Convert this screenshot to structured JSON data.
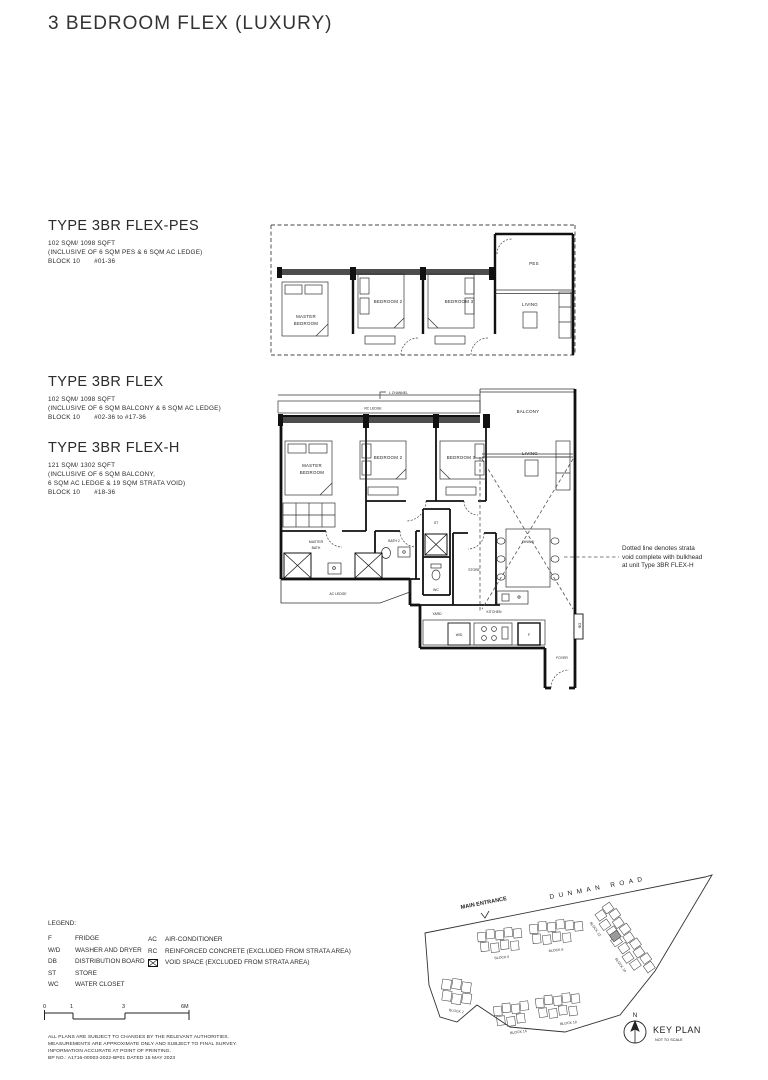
{
  "title": "3 BEDROOM FLEX (LUXURY)",
  "types": {
    "pes": {
      "name": "TYPE 3BR FLEX-PES",
      "area": "102 SQM/ 1098 SQFT",
      "line1": "(INCLUSIVE OF 6 SQM PES & 6 SQM AC LEDGE)",
      "block": "BLOCK 10",
      "stack": "#01-36"
    },
    "flex": {
      "name": "TYPE 3BR FLEX",
      "area": "102 SQM/ 1098 SQFT",
      "line1": "(INCLUSIVE OF 6 SQM BALCONY & 6 SQM AC LEDGE)",
      "block": "BLOCK 10",
      "stack": "#02-36 to #17-36"
    },
    "flexh": {
      "name": "TYPE 3BR FLEX-H",
      "area": "121 SQM/ 1302 SQFT",
      "line1": "(INCLUSIVE OF 6 SQM BALCONY,",
      "line2": "6 SQM AC LEDGE & 19 SQM STRATA VOID)",
      "block": "BLOCK 10",
      "stack": "#18-36"
    }
  },
  "plan_pes": {
    "master1": "MASTER",
    "master2": "BEDROOM",
    "bedroom2": "BEDROOM 2",
    "bedroom3": "BEDROOM 3",
    "living": "LIVING",
    "pes": "PES"
  },
  "plan_main": {
    "l_channel": "L CHANNEL",
    "rc_ledge": "RC LEDGE",
    "balcony": "BALCONY",
    "master1": "MASTER",
    "master2": "BEDROOM",
    "bedroom2": "BEDROOM 2",
    "bedroom3": "BEDROOM 3",
    "living": "LIVING",
    "mbath1": "MASTER",
    "mbath2": "BATH",
    "bath2": "BATH 2",
    "st": "ST",
    "store": "STORE",
    "wc": "WC",
    "dining": "DINING",
    "ac_ledge": "AC LEDGE",
    "yard": "YARD",
    "kitchen": "KITCHEN",
    "wd": "W/D",
    "f": "F",
    "foyer": "FOYER",
    "db": "DB"
  },
  "annotation": {
    "line1": "Dotted line denotes strata",
    "line2": "void complete with bulkhead",
    "line3": "at unit Type 3BR FLEX-H"
  },
  "legend": {
    "heading": "LEGEND:",
    "left": [
      {
        "abbr": "F",
        "desc": "FRIDGE"
      },
      {
        "abbr": "W/D",
        "desc": "WASHER AND DRYER"
      },
      {
        "abbr": "DB",
        "desc": "DISTRIBUTION BOARD"
      },
      {
        "abbr": "ST",
        "desc": "STORE"
      },
      {
        "abbr": "WC",
        "desc": "WATER CLOSET"
      }
    ],
    "right": [
      {
        "abbr": "AC",
        "desc": "AIR-CONDITIONER"
      },
      {
        "abbr": "RC",
        "desc": "REINFORCED CONCRETE (EXCLUDED FROM STRATA AREA)"
      },
      {
        "abbr": "",
        "desc": "VOID SPACE (EXCLUDED FROM STRATA AREA)"
      }
    ]
  },
  "scale": {
    "t0": "0",
    "t1": "1",
    "t3": "3",
    "t6": "6M"
  },
  "disclaimer": {
    "line1": "ALL PLANS ARE SUBJECT TO CHANGES BY THE RELEVANT AUTHORITIES.",
    "line2": "MEASUREMENTS ARE APPROXIMATE ONLY AND SUBJECT TO FINAL SURVEY.",
    "line3": "INFORMATION ACCURATE AT POINT OF PRINTING.",
    "line4": "BP NO.: A1716-00003-2022-BP01 DATED 15 MAY 2023"
  },
  "keyplan": {
    "entrance": "MAIN ENTRANCE",
    "road": "DUNMAN ROAD",
    "b2": "BLOCK 2",
    "b6": "BLOCK 6",
    "b8": "BLOCK 8",
    "b10": "BLOCK 10",
    "b12": "BLOCK 12",
    "b16": "BLOCK 16",
    "b18": "BLOCK 18",
    "north": "N",
    "title": "KEY PLAN",
    "subtitle": "NOT TO SCALE"
  }
}
